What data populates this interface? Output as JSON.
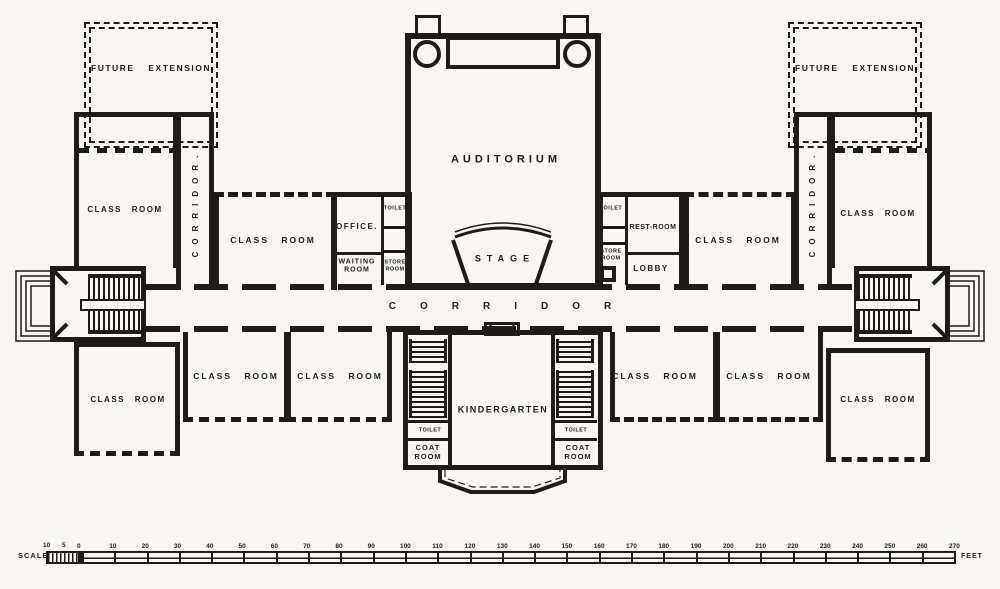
{
  "colors": {
    "ink": "#1d1c1a",
    "paper": "#f7f6f2"
  },
  "rooms": {
    "future_extension_left": "FUTURE EXTENSION",
    "future_extension_right": "FUTURE EXTENSION",
    "class_room_wing_upper_left": "CLASS ROOM",
    "class_room_upper_left": "CLASS ROOM",
    "office": "OFFICE.",
    "toilet_upper_left": "TOILET",
    "waiting_room": "WAITING ROOM",
    "store_room_left": "STORE ROOM",
    "auditorium": "AUDITORIUM",
    "stage": "STAGE",
    "toilet_upper_right": "TOILET",
    "rest_room": "REST-ROOM",
    "store_room_right": "STORE ROOM",
    "lobby": "LOBBY",
    "class_room_upper_right": "CLASS ROOM",
    "class_room_wing_upper_right": "CLASS ROOM",
    "corridor_left": "CORRIDOR.",
    "corridor_right": "CORRIDOR.",
    "corridor_main": "CORRIDOR",
    "class_room_wing_lower_left": "CLASS ROOM",
    "class_room_lower_1": "CLASS ROOM",
    "class_room_lower_2": "CLASS ROOM",
    "kindergarten": "KINDERGARTEN",
    "toilet_kg_left": "TOILET",
    "coat_room_left": "COAT ROOM",
    "toilet_kg_right": "TOILET",
    "coat_room_right": "COAT ROOM",
    "class_room_lower_3": "CLASS ROOM",
    "class_room_lower_4": "CLASS ROOM",
    "class_room_wing_lower_right": "CLASS ROOM"
  },
  "scale_bar": {
    "label": "SCALE",
    "unit": "FEET",
    "sub_ticks": [
      "10",
      "5"
    ],
    "ticks": [
      0,
      10,
      20,
      30,
      40,
      50,
      60,
      70,
      80,
      90,
      100,
      110,
      120,
      130,
      140,
      150,
      160,
      170,
      180,
      190,
      200,
      210,
      220,
      230,
      240,
      250,
      260,
      270
    ]
  }
}
